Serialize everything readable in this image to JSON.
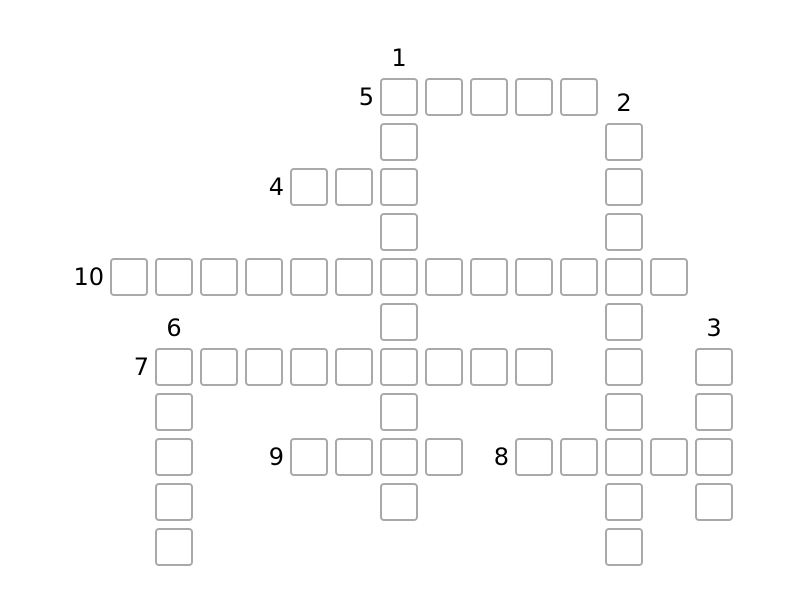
{
  "colors": {
    "background": "#ffffff",
    "cell_fill": "#ffffff",
    "cell_border": "#a9a9a9",
    "number_text": "#000000"
  },
  "puzzle": {
    "type": "crossword",
    "rows": 11,
    "cols": 14,
    "cell_value_placeholder": "",
    "words": [
      {
        "number": 1,
        "direction": "down",
        "row": 0,
        "col": 6,
        "length": 10
      },
      {
        "number": 2,
        "direction": "down",
        "row": 1,
        "col": 11,
        "length": 10
      },
      {
        "number": 3,
        "direction": "down",
        "row": 6,
        "col": 13,
        "length": 4
      },
      {
        "number": 4,
        "direction": "across",
        "row": 2,
        "col": 4,
        "length": 3
      },
      {
        "number": 5,
        "direction": "across",
        "row": 0,
        "col": 6,
        "length": 5
      },
      {
        "number": 6,
        "direction": "down",
        "row": 6,
        "col": 1,
        "length": 5
      },
      {
        "number": 7,
        "direction": "across",
        "row": 6,
        "col": 1,
        "length": 9
      },
      {
        "number": 8,
        "direction": "across",
        "row": 8,
        "col": 9,
        "length": 5
      },
      {
        "number": 9,
        "direction": "across",
        "row": 8,
        "col": 4,
        "length": 4
      },
      {
        "number": 10,
        "direction": "across",
        "row": 4,
        "col": 0,
        "length": 13
      }
    ]
  }
}
